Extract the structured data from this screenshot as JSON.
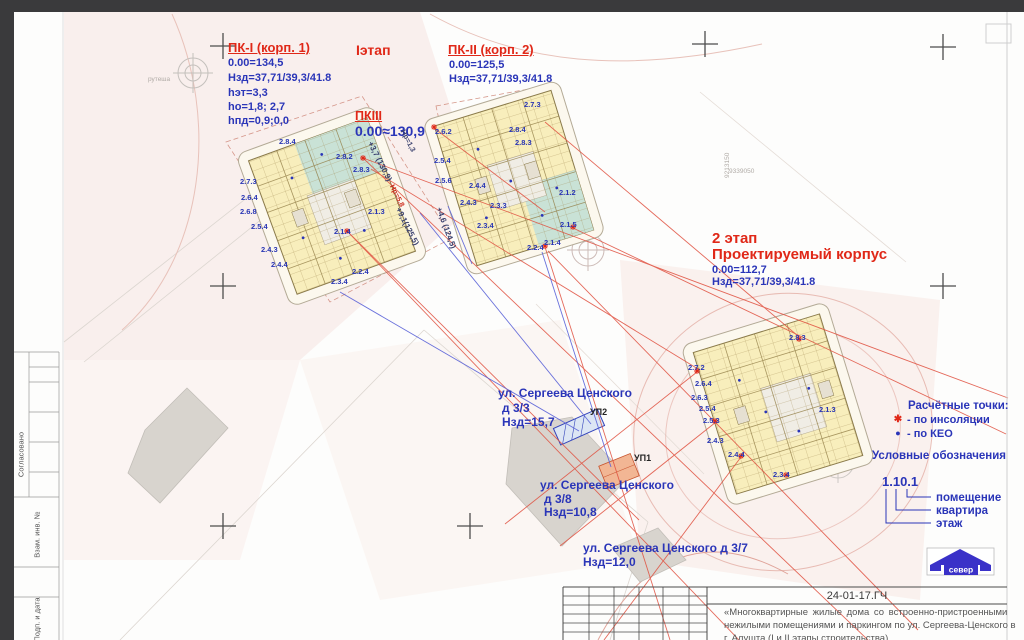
{
  "sheet": {
    "code": "24-01-17.ГЧ",
    "desc_lines": [
      "«Многоквартирные жилые дома со встроенно-пристроенными",
      "нежилыми помещениями и паркингом по ул. Сергеева-Ценского в",
      "г. Алушта (I и II этапы строительства)"
    ],
    "sidebar": [
      "Согласовано",
      "Взам. инв. №",
      "Подп. и дата"
    ],
    "north_label": "север"
  },
  "blocks": {
    "pk1": {
      "title": "ПК-I (корп. 1)",
      "lines": [
        "0.00=134,5",
        "Нзд=37,71/39,3/41.8",
        "hэт=3,3",
        "ho=1,8; 2,7",
        "hпд=0,9;0,0"
      ]
    },
    "stage1": "Iэтап",
    "pk3": {
      "title": "ПКIII",
      "value": "0.00≈130,9"
    },
    "pk2": {
      "title": "ПК-II (корп. 2)",
      "lines": [
        "0.00=125,5",
        "Нзд=37,71/39,3/41.8"
      ]
    },
    "stage2": {
      "l1": "2 этап",
      "l2": "Проектируемый корпус",
      "lines": [
        "0.00=112,7",
        "Нзд=37,71/39,3/41.8"
      ]
    }
  },
  "legend": {
    "points_title": "Расчётные точки:",
    "items": [
      {
        "sym": "✱",
        "label": "- по инсоляции"
      },
      {
        "sym": "●",
        "label": "- по КЕО"
      }
    ],
    "symbols_title": "Условные обозначения",
    "code": "1.10.1",
    "code_labels": [
      "помещение",
      "квартира",
      "этаж"
    ]
  },
  "streets": [
    {
      "name": "ул. Сергеева Ценского",
      "num": "д 3/3",
      "h": "Нзд=15,7"
    },
    {
      "name": "ул. Сергеева Ценского",
      "num": "д 3/8",
      "h": "Нзд=10,8"
    },
    {
      "name": "ул. Сергеева Ценского д 3/7",
      "num": "",
      "h": "Нзд=12,0"
    }
  ],
  "ramps": [
    {
      "t": "УП2",
      "x": 590,
      "y": 407
    },
    {
      "t": "УП1",
      "x": 634,
      "y": 453
    }
  ],
  "unit_labels": [
    {
      "t": "2.8.4",
      "x": 279,
      "y": 137
    },
    {
      "t": "2.8.2",
      "x": 336,
      "y": 152
    },
    {
      "t": "2.8.3",
      "x": 353,
      "y": 165
    },
    {
      "t": "2.7.3",
      "x": 240,
      "y": 177
    },
    {
      "t": "2.6.4",
      "x": 241,
      "y": 193
    },
    {
      "t": "2.6.8",
      "x": 240,
      "y": 207
    },
    {
      "t": "2.5.4",
      "x": 251,
      "y": 222
    },
    {
      "t": "2.4.3",
      "x": 261,
      "y": 245
    },
    {
      "t": "2.4.4",
      "x": 271,
      "y": 260
    },
    {
      "t": "2.1.3",
      "x": 368,
      "y": 207
    },
    {
      "t": "2.1.4",
      "x": 334,
      "y": 227
    },
    {
      "t": "2.2.4",
      "x": 352,
      "y": 267
    },
    {
      "t": "2.3.4",
      "x": 331,
      "y": 277
    },
    {
      "t": "2.7.3",
      "x": 524,
      "y": 100
    },
    {
      "t": "2.8.4",
      "x": 509,
      "y": 125
    },
    {
      "t": "2.8.3",
      "x": 515,
      "y": 138
    },
    {
      "t": "2.6.2",
      "x": 435,
      "y": 127
    },
    {
      "t": "2.5.4",
      "x": 434,
      "y": 156
    },
    {
      "t": "2.5.6",
      "x": 435,
      "y": 176
    },
    {
      "t": "2.4.4",
      "x": 469,
      "y": 181
    },
    {
      "t": "2.4.3",
      "x": 460,
      "y": 198
    },
    {
      "t": "2.3.3",
      "x": 490,
      "y": 201
    },
    {
      "t": "2.3.4",
      "x": 477,
      "y": 221
    },
    {
      "t": "2.1.2",
      "x": 559,
      "y": 188
    },
    {
      "t": "2.1.5",
      "x": 560,
      "y": 220
    },
    {
      "t": "2.1.4",
      "x": 544,
      "y": 238
    },
    {
      "t": "2.2.4",
      "x": 527,
      "y": 243
    },
    {
      "t": "2.8.3",
      "x": 789,
      "y": 333
    },
    {
      "t": "2.7.2",
      "x": 688,
      "y": 363
    },
    {
      "t": "2.6.4",
      "x": 695,
      "y": 379
    },
    {
      "t": "2.6.3",
      "x": 691,
      "y": 393
    },
    {
      "t": "2.5.4",
      "x": 699,
      "y": 404
    },
    {
      "t": "2.5.3",
      "x": 703,
      "y": 416
    },
    {
      "t": "2.4.3",
      "x": 707,
      "y": 436
    },
    {
      "t": "2.4.4",
      "x": 728,
      "y": 450
    },
    {
      "t": "2.3.4",
      "x": 773,
      "y": 470
    },
    {
      "t": "2.1.3",
      "x": 819,
      "y": 405
    }
  ],
  "ray_labels": [
    {
      "t": "+3,7 (130,9)",
      "x": 374,
      "y": 140,
      "r": 63
    },
    {
      "t": "Нр=1,3",
      "x": 407,
      "y": 128,
      "r": 63,
      "cls": "sm"
    },
    {
      "t": "Нр=5,8",
      "x": 396,
      "y": 183,
      "r": 63,
      "cls": "sm red"
    },
    {
      "t": "+9,1(125,5)",
      "x": 402,
      "y": 206,
      "r": 63
    },
    {
      "t": "+4,6 (124,5)",
      "x": 443,
      "y": 206,
      "r": 70
    }
  ],
  "faint_labels": [
    {
      "t": "9213150",
      "x": 724,
      "y": 178,
      "r": -90
    },
    {
      "t": "9339050",
      "x": 729,
      "y": 168
    },
    {
      "t": "рутеша",
      "x": 148,
      "y": 76
    }
  ]
}
